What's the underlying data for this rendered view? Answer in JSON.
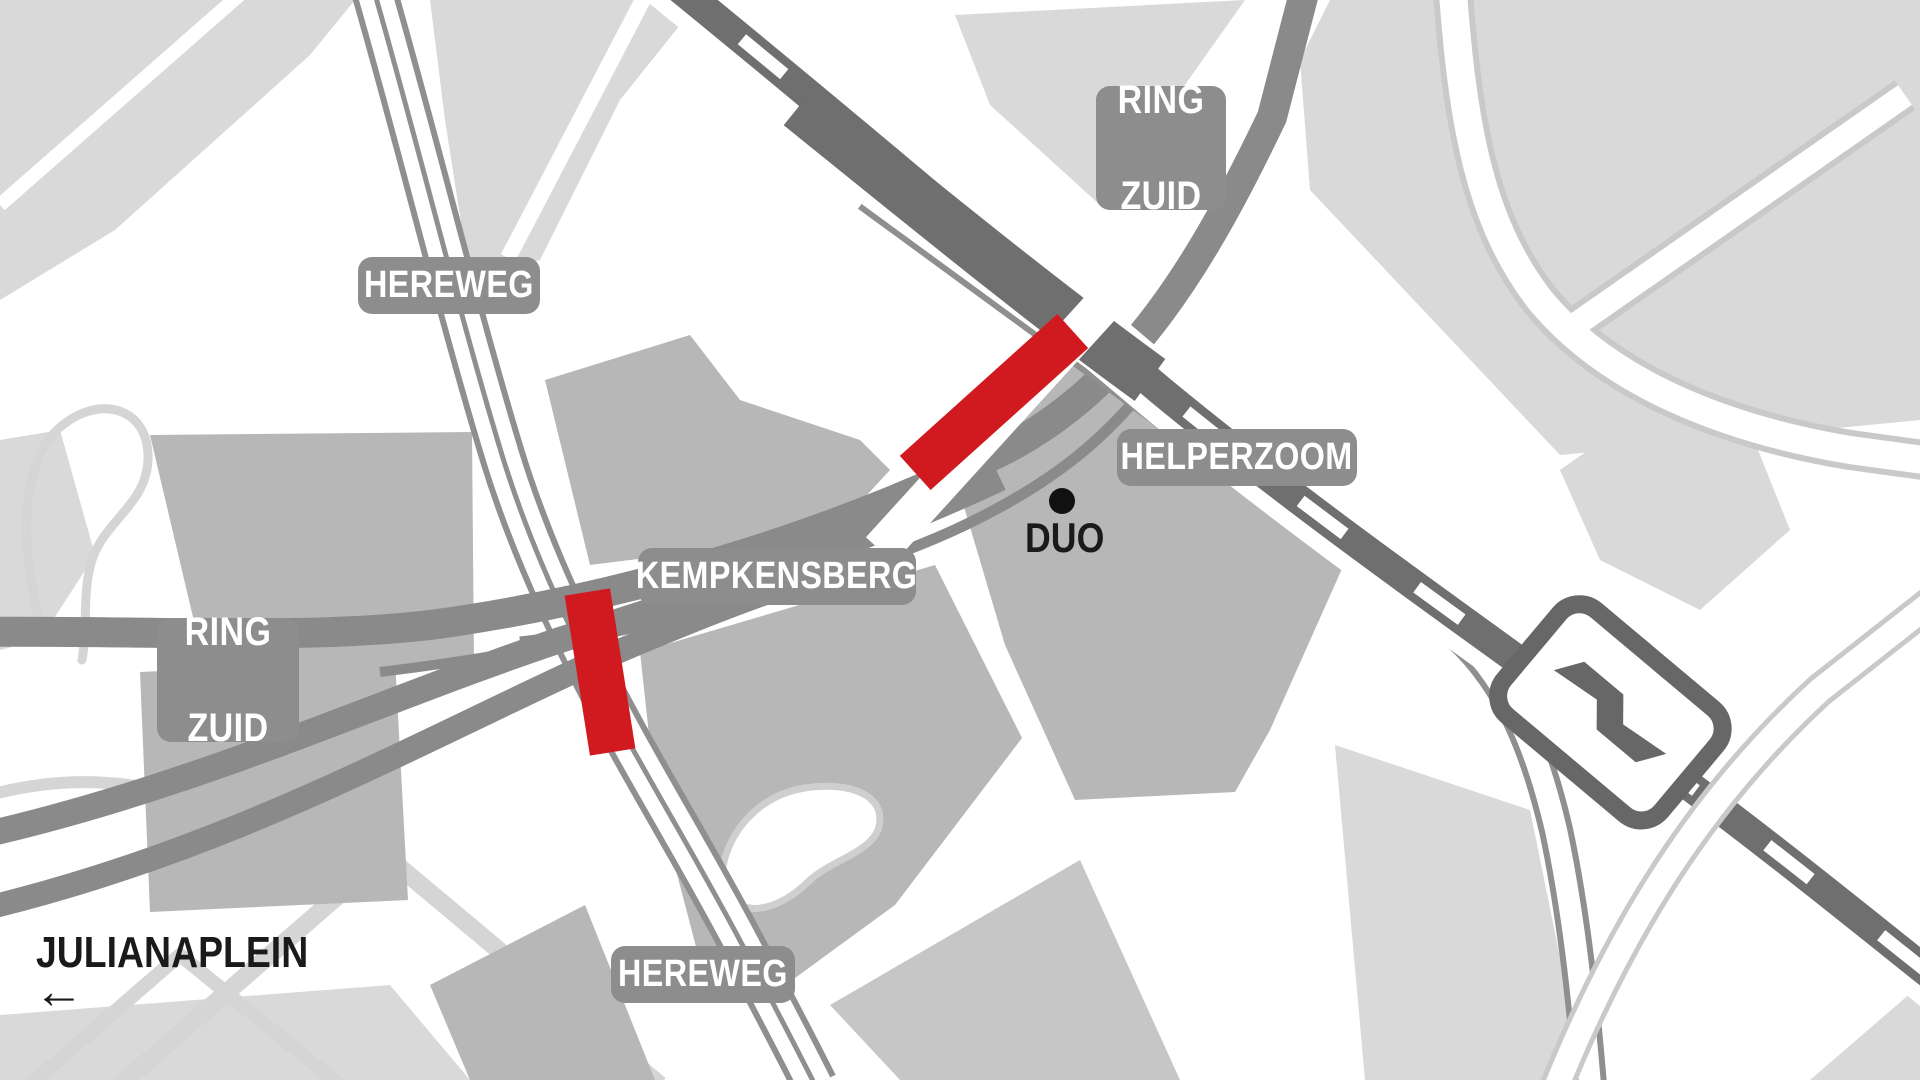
{
  "map": {
    "title": "Ring Zuid Groningen road closure map",
    "labels": {
      "ring_zuid_top": {
        "line1": "RING",
        "line2": "ZUID"
      },
      "ring_zuid_left": {
        "line1": "RING",
        "line2": "ZUID"
      },
      "hereweg_top": "HEREWEG",
      "hereweg_bottom": "HEREWEG",
      "kempkensberg": "KEMPKENSBERG",
      "helperzoom": "HELPERZOOM",
      "duo": "DUO",
      "julianaplein": "JULIANAPLEIN",
      "julianaplein_arrow": "←"
    },
    "markers": {
      "duo_dot": "point-marker",
      "ns_station": "ns-railway-station-logo"
    },
    "closures": [
      {
        "id": "closure-kempkensberg-rail-crossing",
        "color": "#d01a20"
      },
      {
        "id": "closure-hereweg",
        "color": "#d01a20"
      }
    ],
    "colors": {
      "closure_red": "#d01a20",
      "label_pill": "#8d8d8d",
      "highway": "#8a8a8a",
      "railway": "#6f6f6f",
      "station_outline": "#676767",
      "block_light": "#d9d9d9",
      "block_mid": "#b7b7b7",
      "path_casing_light": "#c9c9c9",
      "background": "#ffffff"
    }
  }
}
